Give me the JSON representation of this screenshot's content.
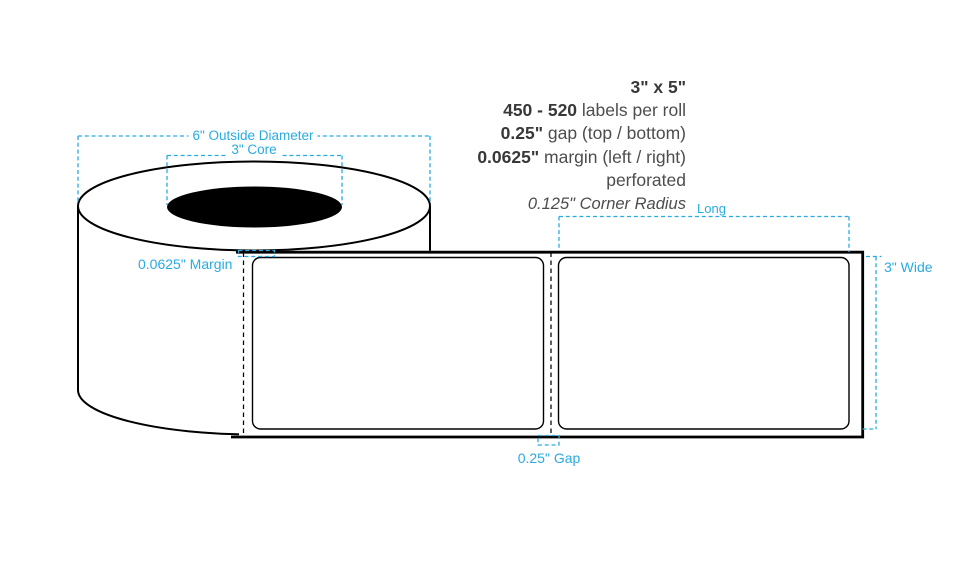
{
  "title": "Label roll dimension diagram",
  "colors": {
    "accent_cyan": "#29abe2",
    "ink": "#000000",
    "spec_text": "#4d4d4d",
    "spec_text_bold": "#383838",
    "core_fill": "#000000"
  },
  "specs": [
    {
      "bold": "3\" x 5\"",
      "rest": ""
    },
    {
      "bold": "450 - 520",
      "rest": " labels per roll"
    },
    {
      "bold": "0.25\"",
      "rest": " gap (top / bottom)"
    },
    {
      "bold": "0.0625\"",
      "rest": " margin (left / right)"
    },
    {
      "bold": "",
      "rest": "perforated"
    },
    {
      "italic": "0.125\" Corner Radius"
    }
  ],
  "annotations": {
    "outside_diameter": "6\" Outside Diameter",
    "core": "3\" Core",
    "margin": "0.0625\" Margin",
    "gap": "0.25\" Gap",
    "long": "Long",
    "wide": "3\" Wide"
  },
  "dimensions": {
    "label_size": "3\" x 5\"",
    "labels_per_roll": "450 - 520",
    "gap_top_bottom": "0.25\"",
    "margin_left_right": "0.0625\"",
    "finish": "perforated",
    "corner_radius": "0.125\"",
    "outside_diameter": "6\"",
    "core": "3\"",
    "label_wide": "3\"",
    "label_long": "5\""
  }
}
